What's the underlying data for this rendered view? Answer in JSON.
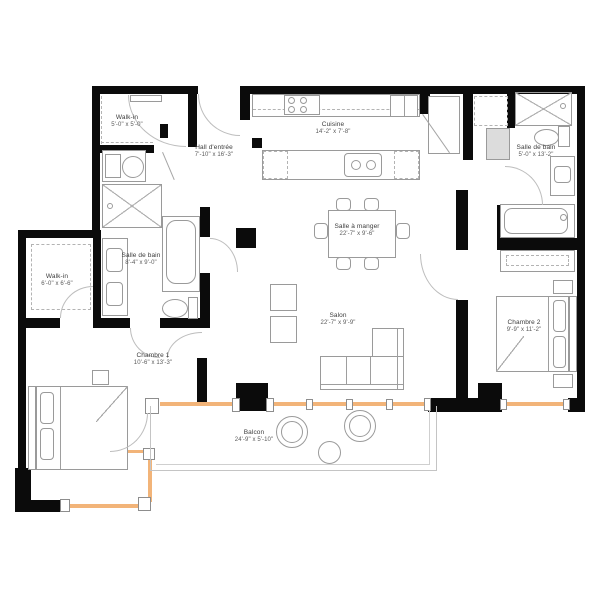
{
  "plan": {
    "type": "apartment-floor-plan",
    "colors": {
      "wall": "#0b0b0b",
      "window": "#f2b479",
      "furniture_line": "#9a9a9a"
    },
    "rooms": {
      "walkin1": {
        "name": "Walk-in",
        "dims": "5'-0\" x 5'-0\""
      },
      "hall": {
        "name": "Hall d'entrée",
        "dims": "7'-10\" x 16'-3\""
      },
      "cuisine": {
        "name": "Cuisine",
        "dims": "14'-2\" x 7'-8\""
      },
      "bain2": {
        "name": "Salle de bain",
        "dims": "5'-0\" x 13'-2\""
      },
      "manger": {
        "name": "Salle à manger",
        "dims": "22'-7\" x 9'-6\""
      },
      "walkin2": {
        "name": "Walk-in",
        "dims": "6'-0\" x 6'-6\""
      },
      "bain1": {
        "name": "Salle de bain",
        "dims": "8'-4\" x 9'-0\""
      },
      "salon": {
        "name": "Salon",
        "dims": "22'-7\" x 9'-9\""
      },
      "chambre1": {
        "name": "Chambre 1",
        "dims": "10'-6\" x 13'-3\""
      },
      "chambre2": {
        "name": "Chambre 2",
        "dims": "9'-9\" x 11'-2\""
      },
      "balcon": {
        "name": "Balcon",
        "dims": "24'-9\" x 5'-10\""
      }
    }
  }
}
